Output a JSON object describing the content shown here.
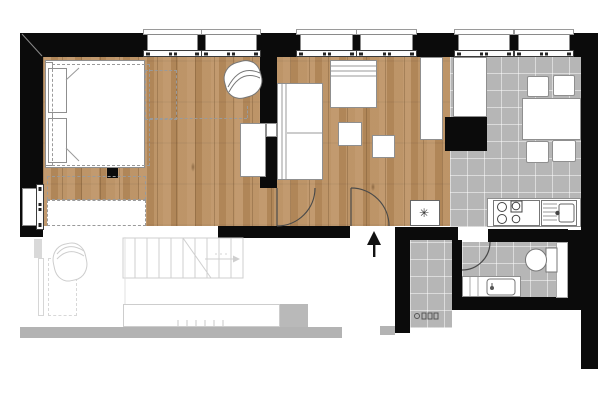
{
  "title": "apartment-floor-plan",
  "colors": {
    "wall": "#0b0b0b",
    "wood_base": "#b98e5f",
    "tile": "#b6b6b6",
    "furniture_stroke": "#8f8f8f",
    "faded_stroke": "#cdcdcd",
    "faded_fill": "#b3b3b3",
    "door_stroke": "#4a4a4a"
  },
  "rooms": [
    {
      "name": "sleeping-area",
      "floor": "wood"
    },
    {
      "name": "living-area",
      "floor": "wood"
    },
    {
      "name": "hallway",
      "floor": "wood"
    },
    {
      "name": "kitchen",
      "floor": "tile"
    },
    {
      "name": "bathroom",
      "floor": "tile"
    },
    {
      "name": "entry-vestibule",
      "floor": "tile"
    },
    {
      "name": "lower-level-faded",
      "floor": "none"
    }
  ],
  "windows": {
    "top_count": 6,
    "left_count": 1,
    "faded_lower_count": 1
  },
  "fixtures": {
    "washing_machine_symbol": "✳"
  },
  "annotations": {
    "entrance_arrow_direction": "up"
  },
  "furniture": [
    "double-bed",
    "pillows",
    "dashed-wardrobe-outlines",
    "structural-column",
    "swivel-armchair",
    "desk",
    "sofa",
    "daybed-seat",
    "coffee-table-small",
    "coffee-table-small",
    "hall-wardrobe",
    "tall-kitchen-cabinet",
    "washing-machine",
    "kitchen-counter",
    "cooktop-4-burner",
    "kitchen-sink",
    "dining-table",
    "dining-chairs-x4",
    "toilet",
    "bathroom-vanity-sink",
    "duct-shaft",
    "faded-armchair",
    "faded-kitchen-counter",
    "faded-staircase"
  ]
}
